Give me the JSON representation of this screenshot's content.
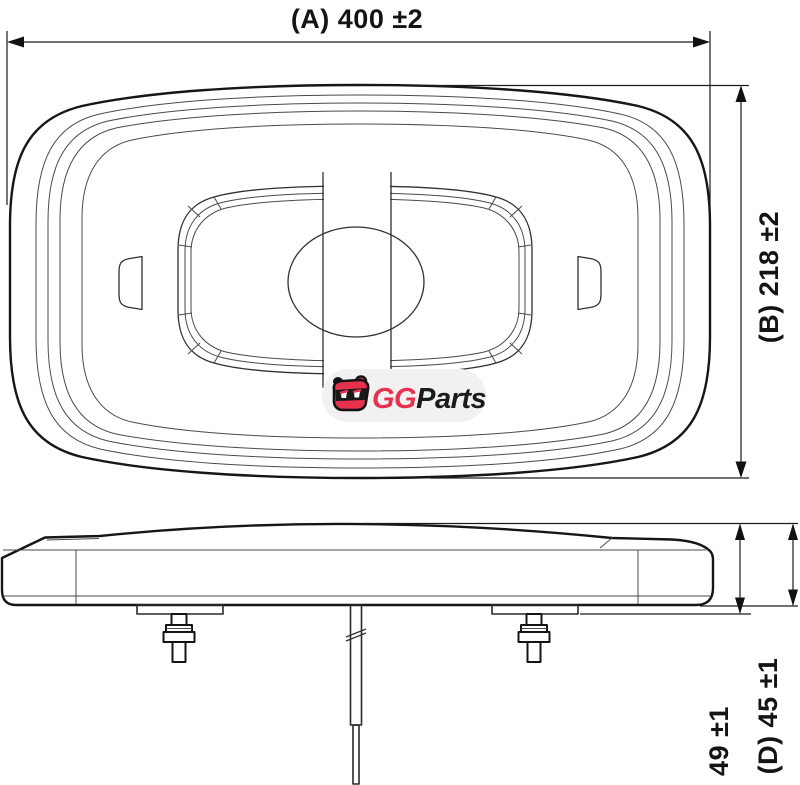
{
  "drawing": {
    "kind": "product-dimension-drawing",
    "background": "#ffffff",
    "line_color": "#161616",
    "thin_line_color": "#4a4a4a",
    "dim_color": "#1c1c1c"
  },
  "dimensions": {
    "width_a": {
      "label": "(A) 400 ±2",
      "orientation": "horizontal"
    },
    "depth_b": {
      "label": "(B) 218 ±2",
      "orientation": "vertical"
    },
    "height_total": {
      "label": "49 ±1",
      "orientation": "vertical"
    },
    "height_d": {
      "label": "(D) 45 ±1",
      "orientation": "vertical"
    }
  },
  "watermark": {
    "brand_first": "GG",
    "brand_second": "Parts",
    "brand_red": "#e8304f",
    "brand_dark": "#1b1b1b",
    "pill_color": "#f1f1f1"
  }
}
